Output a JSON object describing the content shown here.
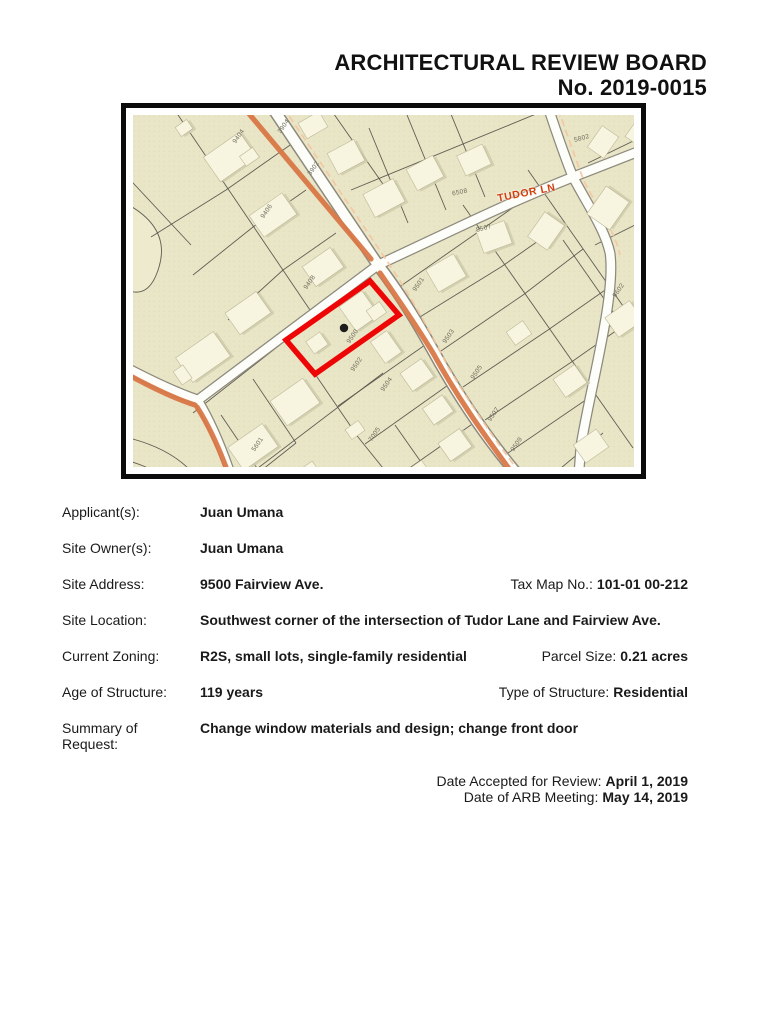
{
  "header": {
    "title": "ARCHITECTURAL REVIEW BOARD",
    "case_number": "No. 2019-0015"
  },
  "map": {
    "road_label": {
      "t": "TUDOR LN",
      "x": 394,
      "y": 78,
      "r": -11
    },
    "subject_marker_label": {
      "t": "9500",
      "x": 221,
      "y": 222,
      "r": -55
    },
    "parcel_labels": [
      {
        "t": "9404",
        "x": 107,
        "y": 22,
        "r": -55
      },
      {
        "t": "3904",
        "x": 152,
        "y": 12,
        "r": -55
      },
      {
        "t": "3902",
        "x": 182,
        "y": 54,
        "r": -55
      },
      {
        "t": "9406",
        "x": 135,
        "y": 97,
        "r": -55
      },
      {
        "t": "9408",
        "x": 178,
        "y": 168,
        "r": -55
      },
      {
        "t": "9502",
        "x": 225,
        "y": 250,
        "r": -55
      },
      {
        "t": "9504",
        "x": 255,
        "y": 270,
        "r": -55
      },
      {
        "t": "9501",
        "x": 287,
        "y": 170,
        "r": -55
      },
      {
        "t": "9503",
        "x": 317,
        "y": 222,
        "r": -55
      },
      {
        "t": "9505",
        "x": 345,
        "y": 258,
        "r": -55
      },
      {
        "t": "9507",
        "x": 362,
        "y": 300,
        "r": -55
      },
      {
        "t": "9509",
        "x": 385,
        "y": 330,
        "r": -55
      },
      {
        "t": "8507",
        "x": 352,
        "y": 114,
        "r": -15
      },
      {
        "t": "6508",
        "x": 328,
        "y": 78,
        "r": -12
      },
      {
        "t": "5802",
        "x": 450,
        "y": 24,
        "r": -15
      },
      {
        "t": "9602",
        "x": 487,
        "y": 176,
        "r": -55
      },
      {
        "t": "5601",
        "x": 126,
        "y": 330,
        "r": -55
      },
      {
        "t": "7005",
        "x": 243,
        "y": 320,
        "r": -55
      }
    ],
    "colors": {
      "highlight_red": "#ee0505",
      "road_accent_orange": "#d97747",
      "road_label_red": "#d23c0e",
      "map_background": "#e9e6c8",
      "building_fill": "#f7f4df"
    }
  },
  "form": {
    "rows": [
      {
        "label": "Applicant(s):",
        "value": "Juan Umana"
      },
      {
        "label": "Site Owner(s):",
        "value": "Juan Umana"
      },
      {
        "label": "Site Address:",
        "value": "9500 Fairview Ave.",
        "right_label": "Tax Map No.:",
        "right_value": "101-01 00-212"
      },
      {
        "label": "Site Location:",
        "value": "Southwest corner of the intersection of Tudor Lane and Fairview Ave."
      },
      {
        "label": "Current Zoning:",
        "value": "R2S, small lots, single-family residential",
        "right_label": "Parcel Size:",
        "right_value": "0.21 acres"
      },
      {
        "label": "Age of Structure:",
        "value": "119 years",
        "right_label": "Type of Structure:",
        "right_value": "Residential"
      },
      {
        "label": "Summary of Request:",
        "value": "Change window materials and design; change front door"
      }
    ],
    "dates": [
      {
        "label": "Date Accepted for Review:",
        "value": "April 1, 2019"
      },
      {
        "label": "Date of ARB Meeting:",
        "value": "May 14, 2019"
      }
    ]
  }
}
